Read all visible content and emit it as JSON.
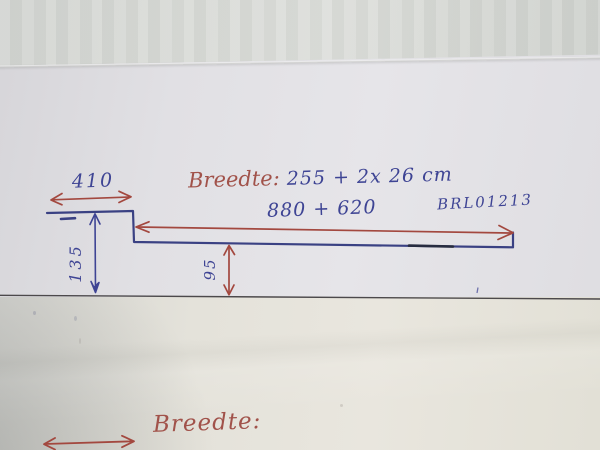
{
  "sketch": {
    "heading": {
      "label": "Breedte:",
      "value": "255 + 2x 26 cm"
    },
    "code": "BRL01213",
    "dimensions": {
      "top_width": "410",
      "left_height": "135",
      "step_height": "95",
      "length_sum": "880 + 620"
    },
    "footer": {
      "label": "Breedte:"
    },
    "colors": {
      "red_ink": "#a1524a",
      "blue_ink": "#3e4494",
      "printed_rule": "#4c494b"
    }
  }
}
